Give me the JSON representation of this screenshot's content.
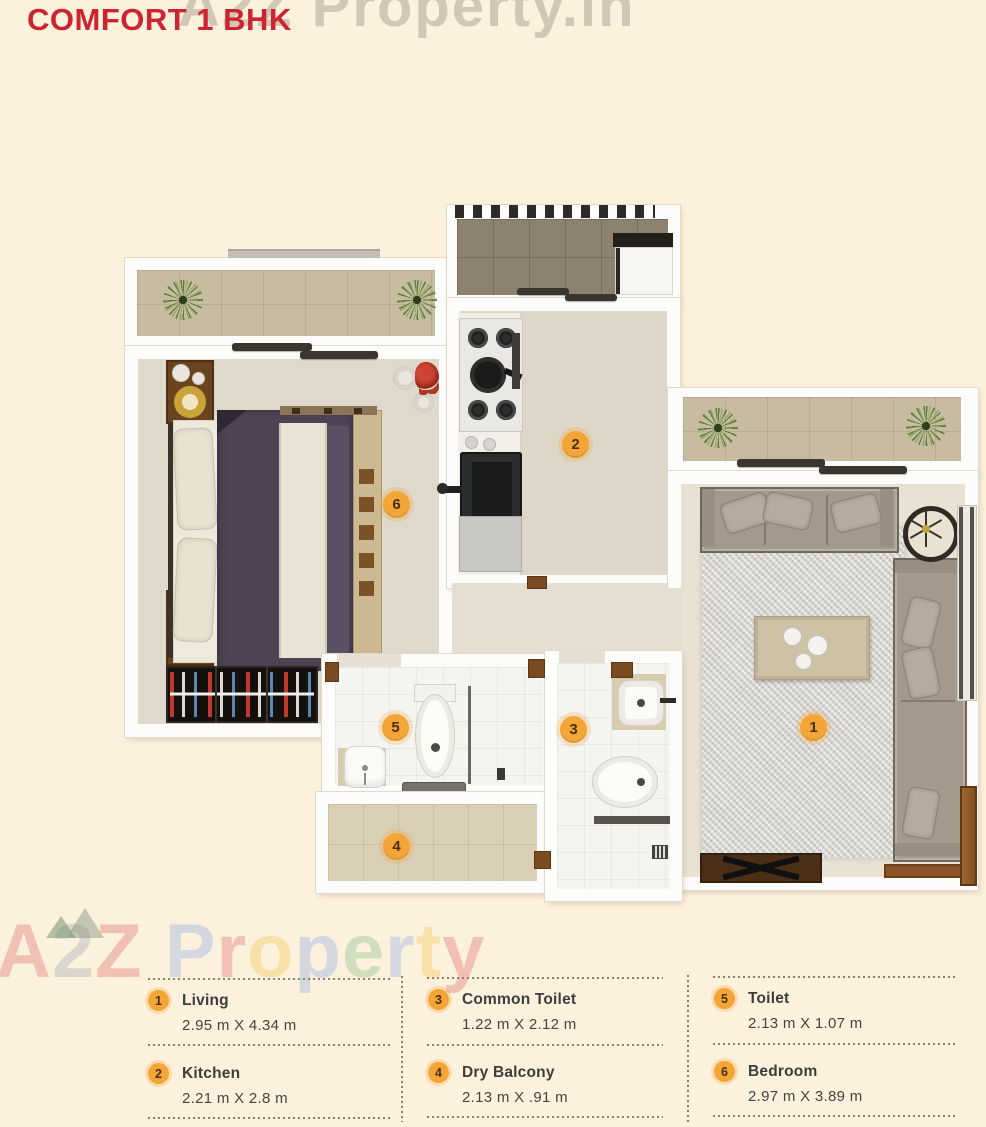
{
  "title": "COMFORT 1 BHK",
  "watermarks": {
    "top": "A2Z Property.in",
    "middle": "A2Z Property",
    "middle_letters": [
      {
        "ch": "A",
        "color": "#d85c5c"
      },
      {
        "ch": "2",
        "color": "#98a0a8"
      },
      {
        "ch": "Z",
        "color": "#d85c5c"
      },
      {
        "ch": " ",
        "color": "#000000"
      },
      {
        "ch": "P",
        "color": "#7ba3ea"
      },
      {
        "ch": "r",
        "color": "#d85c5c"
      },
      {
        "ch": "o",
        "color": "#eec13f"
      },
      {
        "ch": "p",
        "color": "#7ba3ea"
      },
      {
        "ch": "e",
        "color": "#74b97a"
      },
      {
        "ch": "r",
        "color": "#7ba3ea"
      },
      {
        "ch": "t",
        "color": "#eec13f"
      },
      {
        "ch": "y",
        "color": "#d85c5c"
      }
    ]
  },
  "colors": {
    "background": "#fcf1dc",
    "title_red": "#ce2330",
    "badge_orange": "#f3a538",
    "badge_text": "#4a3010",
    "legend_text": "#3e3d3b",
    "dotted_line": "#8b7f67",
    "wall_white": "#fcfcfa",
    "floor": "#e7e0d2"
  },
  "plan": {
    "markers": [
      "1",
      "2",
      "3",
      "4",
      "5",
      "6"
    ]
  },
  "legend": {
    "items": [
      {
        "num": "1",
        "label": "Living",
        "dims": "2.95 m X 4.34 m"
      },
      {
        "num": "2",
        "label": "Kitchen",
        "dims": "2.21 m X 2.8 m"
      },
      {
        "num": "3",
        "label": "Common Toilet",
        "dims": "1.22 m X 2.12 m"
      },
      {
        "num": "4",
        "label": "Dry Balcony",
        "dims": "2.13 m X .91 m"
      },
      {
        "num": "5",
        "label": "Toilet",
        "dims": "2.13 m X 1.07 m"
      },
      {
        "num": "6",
        "label": "Bedroom",
        "dims": "2.97 m X 3.89 m"
      }
    ]
  }
}
